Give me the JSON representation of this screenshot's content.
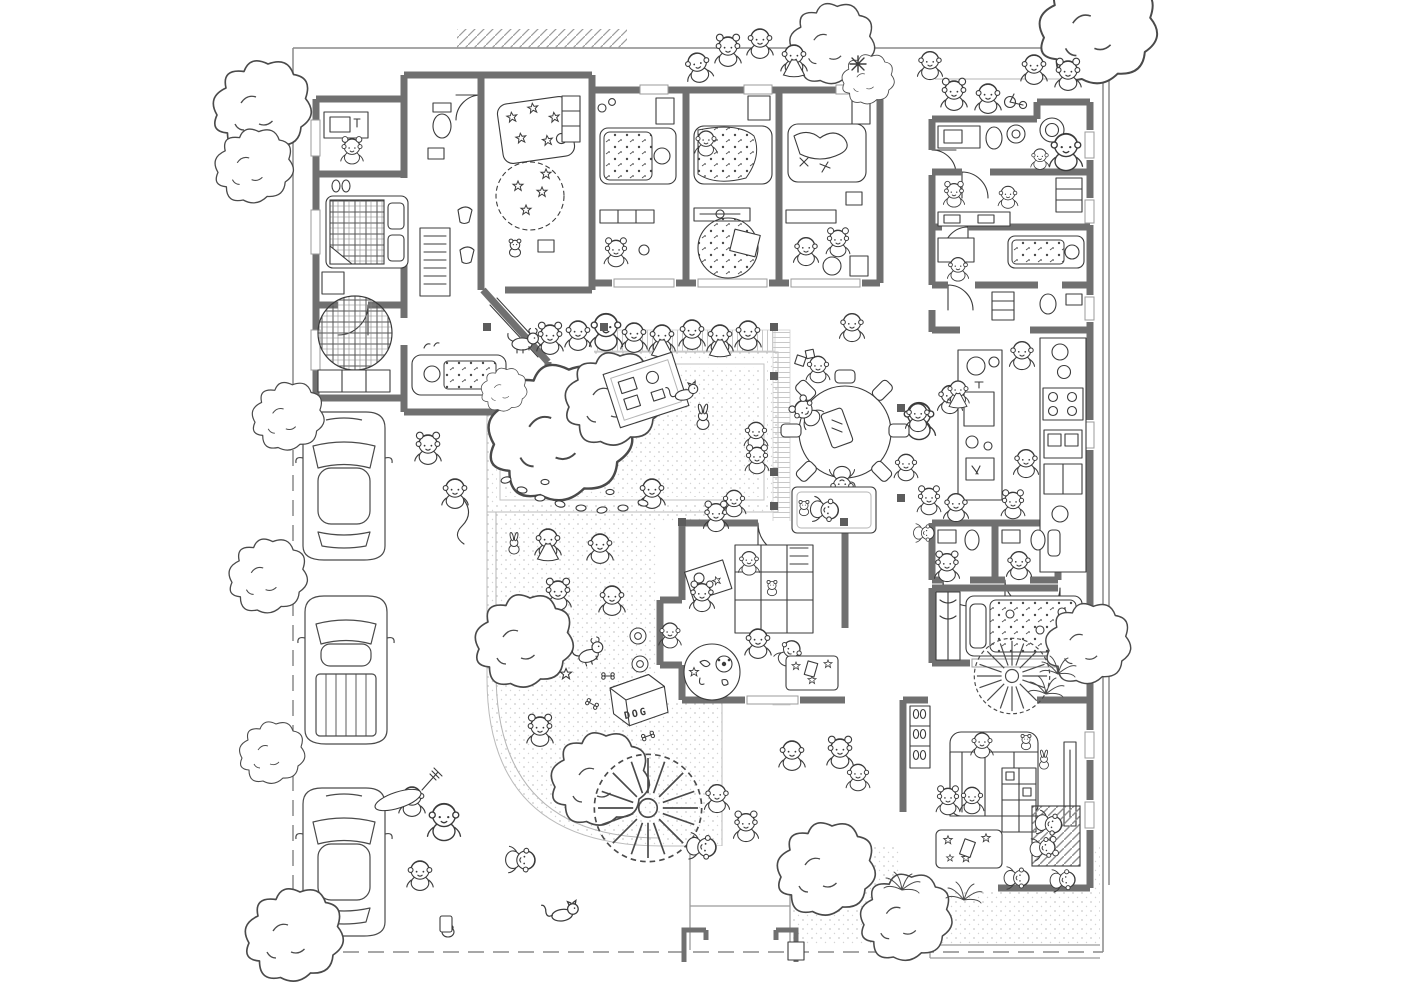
{
  "artwork": {
    "description": "Hand-drawn black-and-white kindergarten floor plan with children, pets, furniture, garden and parking"
  },
  "labels": {
    "dog_house": "DOG"
  },
  "palette": {
    "wall_gray": "#707070",
    "ink": "#3b3b3b",
    "muted_line": "#9b9b9b",
    "paper": "#ffffff",
    "texture_dot": "#c9c9c9"
  },
  "scene": {
    "cars_parked": 3,
    "car_types": [
      "sedan",
      "pickup-truck",
      "sedan"
    ],
    "dog_houses": 1,
    "round_dining_tables": 1,
    "areas": [
      "nursing-room",
      "staff-bedroom",
      "entry-hall",
      "wc-room",
      "star-playroom",
      "bedroom-1",
      "bedroom-2",
      "bedroom-3",
      "washrooms",
      "kitchen",
      "small-bathrooms",
      "caretaker-bedroom",
      "living-room",
      "climbing-playroom",
      "courtyard-sandpit",
      "lawn-playground",
      "parking-lane",
      "entry-walk",
      "terrace"
    ]
  }
}
